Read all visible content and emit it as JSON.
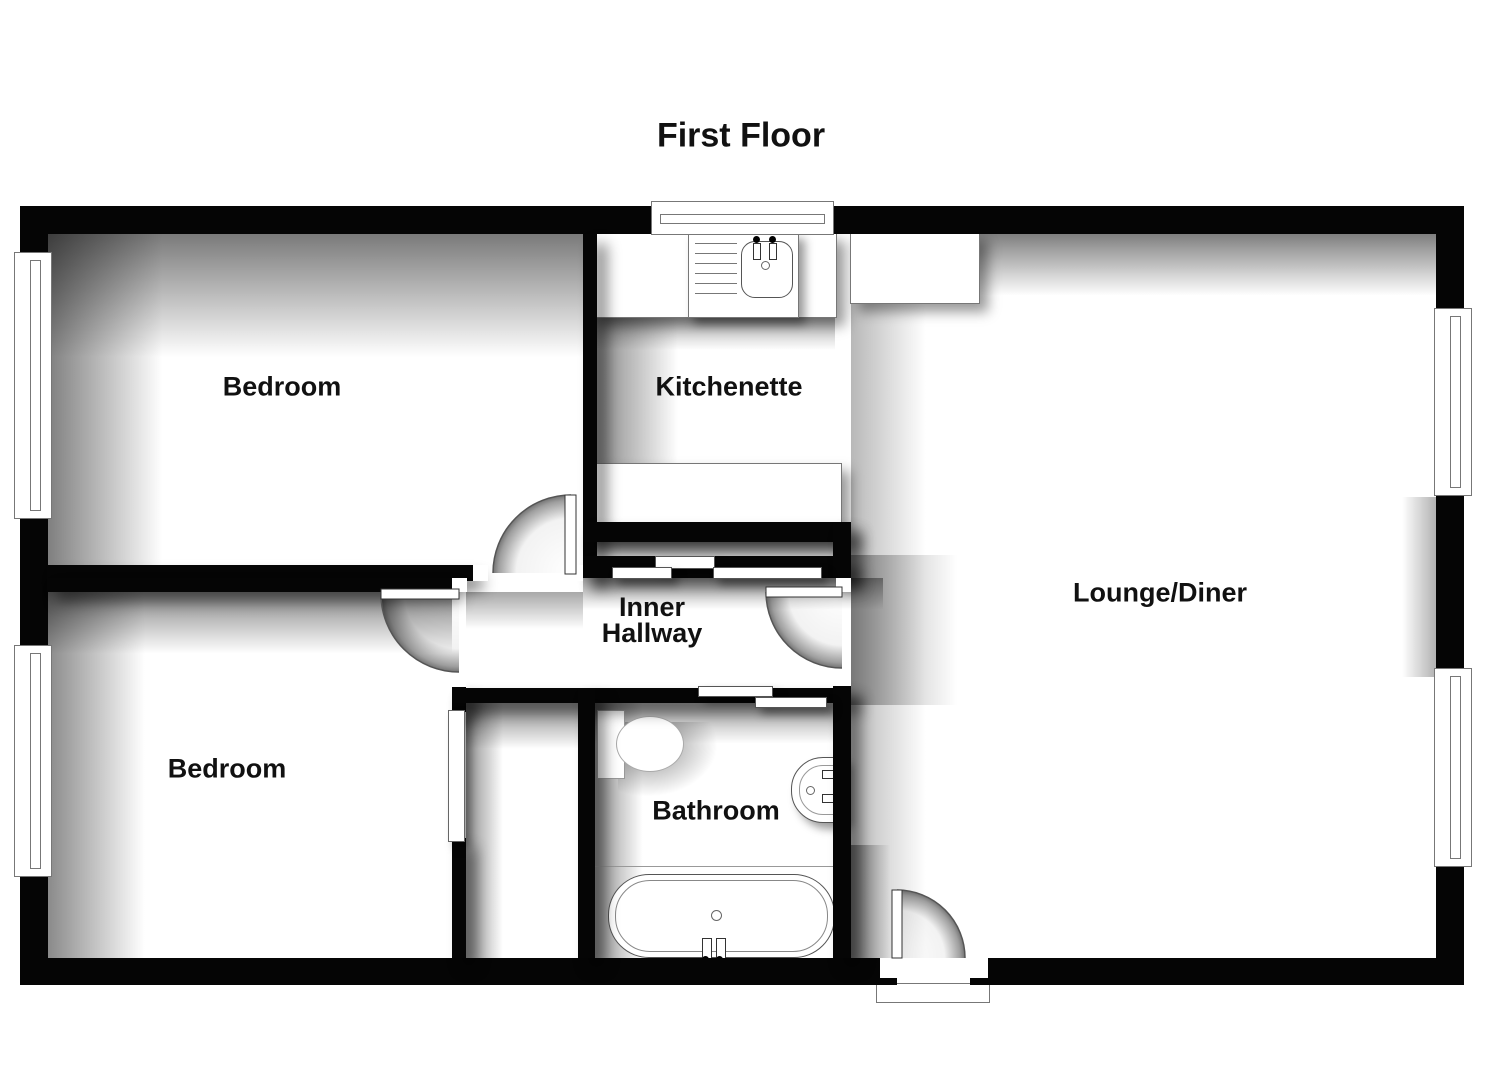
{
  "title": "First Floor",
  "rooms": {
    "bedroom_top": {
      "label": "Bedroom"
    },
    "kitchenette": {
      "label": "Kitchenette"
    },
    "lounge_diner": {
      "label": "Lounge/Diner"
    },
    "inner_hallway": {
      "label_line1": "Inner",
      "label_line2": "Hallway"
    },
    "bedroom_bottom": {
      "label": "Bedroom"
    },
    "bathroom": {
      "label": "Bathroom"
    }
  },
  "doors": [
    {
      "name": "bedroom-top-door",
      "type": "hinged"
    },
    {
      "name": "bedroom-bottom-door",
      "type": "hinged"
    },
    {
      "name": "lounge-hallway-door",
      "type": "hinged"
    },
    {
      "name": "entrance-door",
      "type": "hinged"
    },
    {
      "name": "kitchenette-sliding-door",
      "type": "sliding"
    },
    {
      "name": "bathroom-sliding-door",
      "type": "sliding"
    },
    {
      "name": "bedroom-closet-sliding-door",
      "type": "sliding"
    }
  ],
  "windows_count": 5,
  "fixtures": [
    {
      "name": "kitchen-sink"
    },
    {
      "name": "kitchen-worktop-top"
    },
    {
      "name": "kitchen-worktop-side"
    },
    {
      "name": "kitchen-worktop-bottom"
    },
    {
      "name": "toilet"
    },
    {
      "name": "wash-basin"
    },
    {
      "name": "bath"
    },
    {
      "name": "front-door-threshold"
    }
  ],
  "colors": {
    "wall": "#050505",
    "background": "#ffffff",
    "fixture_outline": "#777777",
    "shadow": "rgba(0,0,0,0.5)",
    "text": "#111111"
  }
}
